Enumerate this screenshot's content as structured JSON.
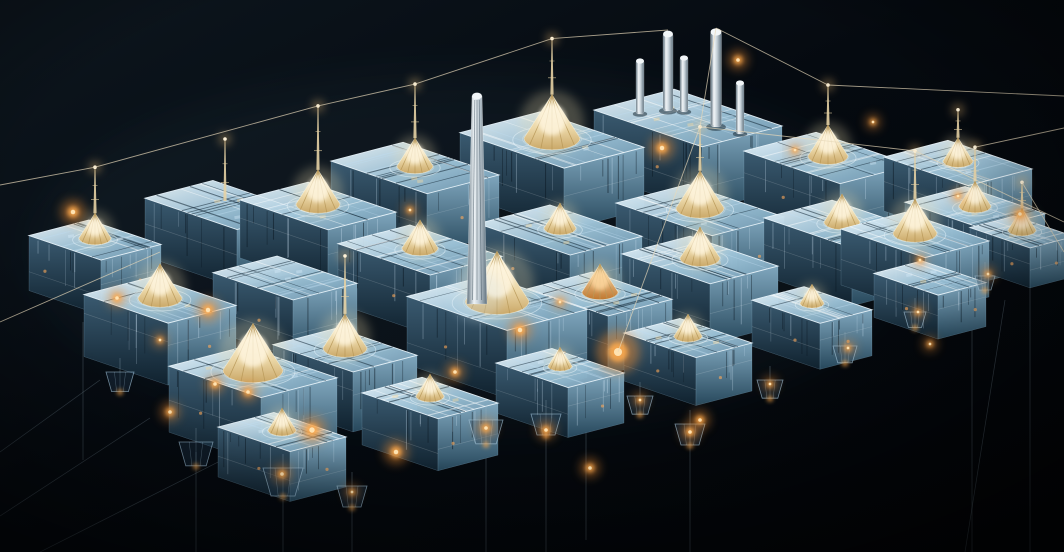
{
  "scene": {
    "width": 1064,
    "height": 552,
    "palette": {
      "bg_top": "#0d161e",
      "bg_mid": "#050a10",
      "bg_bottom": "#020407",
      "ice_top_light": "#eef7fc",
      "ice_top_mid": "#9dc3d8",
      "ice_top_dark": "#6f98b0",
      "face_left_light": "#3a5a70",
      "face_left_dark": "#10222f",
      "face_right_light": "#7fa6bd",
      "face_right_dark": "#27485c",
      "edge_highlight": "#e9f5fc",
      "cone_core": "#fff9e8",
      "cone_mid": "#ecd8a8",
      "cone_rim": "#caa868",
      "cone_warm_core": "#ffe9c0",
      "cone_warm_rim": "#c07830",
      "rib": "#b89858",
      "metal_light": "#eef3f6",
      "metal_dark": "#5f717d",
      "wire": "#e8d9ba",
      "cable": "#9fb8c8",
      "amber": "#e98a30",
      "amber_mid": "#ffab4e",
      "amber_core": "#ffe2b0",
      "bloom": "rgba(110,160,195,0.06)"
    },
    "seed": 7,
    "blocks": [
      {
        "x": 95,
        "y": 240,
        "a": 36,
        "b": 30,
        "h": 55,
        "c": 16,
        "m": 46
      },
      {
        "x": 225,
        "y": 205,
        "a": 46,
        "b": 34,
        "h": 58,
        "c": 0,
        "m": 62
      },
      {
        "x": 318,
        "y": 206,
        "a": 44,
        "b": 34,
        "h": 58,
        "c": 22,
        "m": 64
      },
      {
        "x": 415,
        "y": 168,
        "a": 48,
        "b": 36,
        "h": 60,
        "c": 18,
        "m": 54
      },
      {
        "x": 552,
        "y": 140,
        "a": 52,
        "b": 40,
        "h": 62,
        "c": 28,
        "m": 56
      },
      {
        "x": 688,
        "y": 118,
        "a": 54,
        "b": 40,
        "h": 64,
        "c": 0,
        "m": 0
      },
      {
        "x": 828,
        "y": 158,
        "a": 48,
        "b": 36,
        "h": 60,
        "c": 20,
        "m": 40
      },
      {
        "x": 958,
        "y": 163,
        "a": 42,
        "b": 32,
        "h": 54,
        "c": 15,
        "m": 28
      },
      {
        "x": 160,
        "y": 300,
        "a": 42,
        "b": 34,
        "h": 62,
        "c": 22,
        "m": 0
      },
      {
        "x": 285,
        "y": 278,
        "a": 40,
        "b": 32,
        "h": 58,
        "c": 0,
        "m": 0
      },
      {
        "x": 420,
        "y": 250,
        "a": 46,
        "b": 36,
        "h": 60,
        "c": 18,
        "m": 0
      },
      {
        "x": 560,
        "y": 230,
        "a": 46,
        "b": 36,
        "h": 60,
        "c": 16,
        "m": 0
      },
      {
        "x": 700,
        "y": 210,
        "a": 48,
        "b": 36,
        "h": 60,
        "c": 24,
        "m": 44
      },
      {
        "x": 842,
        "y": 224,
        "a": 44,
        "b": 34,
        "h": 58,
        "c": 18,
        "m": 0
      },
      {
        "x": 975,
        "y": 208,
        "a": 40,
        "b": 30,
        "h": 52,
        "c": 16,
        "m": 34
      },
      {
        "x": 253,
        "y": 372,
        "a": 46,
        "b": 38,
        "h": 66,
        "c": 30,
        "m": 0
      },
      {
        "x": 345,
        "y": 350,
        "a": 40,
        "b": 32,
        "h": 60,
        "c": 22,
        "m": 58
      },
      {
        "x": 497,
        "y": 303,
        "a": 50,
        "b": 40,
        "h": 68,
        "c": 32,
        "m": 0
      },
      {
        "x": 600,
        "y": 294,
        "a": 40,
        "b": 32,
        "h": 58,
        "c": 18,
        "m": 0,
        "warm": true
      },
      {
        "x": 700,
        "y": 260,
        "a": 44,
        "b": 34,
        "h": 60,
        "c": 20,
        "m": 0
      },
      {
        "x": 915,
        "y": 235,
        "a": 42,
        "b": 32,
        "h": 56,
        "c": 22,
        "m": 48
      },
      {
        "x": 282,
        "y": 432,
        "a": 36,
        "b": 28,
        "h": 50,
        "c": 14,
        "m": 0
      },
      {
        "x": 430,
        "y": 398,
        "a": 38,
        "b": 30,
        "h": 52,
        "c": 14,
        "m": 0
      },
      {
        "x": 560,
        "y": 368,
        "a": 36,
        "b": 28,
        "h": 50,
        "c": 12,
        "m": 0
      },
      {
        "x": 688,
        "y": 338,
        "a": 36,
        "b": 28,
        "h": 48,
        "c": 14,
        "m": 0
      },
      {
        "x": 812,
        "y": 305,
        "a": 34,
        "b": 26,
        "h": 46,
        "c": 12,
        "m": 0
      },
      {
        "x": 930,
        "y": 278,
        "a": 32,
        "b": 24,
        "h": 44,
        "c": 0,
        "m": 0
      },
      {
        "x": 1022,
        "y": 232,
        "a": 30,
        "b": 22,
        "h": 40,
        "c": 14,
        "m": 26
      }
    ],
    "towers": [
      {
        "x": 640,
        "y": 60,
        "w": 8,
        "h": 54
      },
      {
        "x": 668,
        "y": 33,
        "w": 10,
        "h": 78
      },
      {
        "x": 684,
        "y": 57,
        "w": 8,
        "h": 55
      },
      {
        "x": 716,
        "y": 31,
        "w": 11,
        "h": 96
      },
      {
        "x": 740,
        "y": 82,
        "w": 8,
        "h": 52
      }
    ],
    "obelisk": {
      "x": 477,
      "top": 96,
      "bottom": 304,
      "w_top": 10,
      "w_base": 20
    },
    "wires": [
      {
        "from": {
          "x": 0,
          "y": 185
        },
        "to": {
          "block": 0
        }
      },
      {
        "from": {
          "block": 0
        },
        "to": {
          "block": 2
        }
      },
      {
        "from": {
          "block": 2
        },
        "to": {
          "block": 3
        }
      },
      {
        "from": {
          "block": 3
        },
        "to": {
          "block": 4
        }
      },
      {
        "from": {
          "block": 4
        },
        "to": {
          "x": 668,
          "y": 30
        }
      },
      {
        "from": {
          "x": 716,
          "y": 28
        },
        "to": {
          "block": 6
        }
      },
      {
        "from": {
          "block": 6
        },
        "to": {
          "x": 1064,
          "y": 96
        }
      },
      {
        "from": {
          "x": 716,
          "y": 28
        },
        "to": {
          "block": 12
        }
      },
      {
        "from": {
          "block": 12
        },
        "to": {
          "block": 20
        }
      },
      {
        "from": {
          "block": 20
        },
        "to": {
          "x": 1064,
          "y": 222
        }
      },
      {
        "from": {
          "block": 14
        },
        "to": {
          "x": 1064,
          "y": 128
        }
      },
      {
        "from": {
          "x": 0,
          "y": 322
        },
        "to": {
          "x": 160,
          "y": 252
        }
      },
      {
        "from": {
          "block": 12
        },
        "to": {
          "x": 618,
          "y": 352
        }
      },
      {
        "from": {
          "block": 27
        },
        "to": {
          "x": 1064,
          "y": 252
        }
      }
    ],
    "cables": [
      {
        "x": 83,
        "y1": 322,
        "y2": 460
      },
      {
        "x": 196,
        "y1": 452,
        "y2": 552
      },
      {
        "x": 283,
        "y1": 470,
        "y2": 552
      },
      {
        "x": 352,
        "y1": 486,
        "y2": 552
      },
      {
        "x": 486,
        "y1": 426,
        "y2": 552
      },
      {
        "x": 546,
        "y1": 400,
        "y2": 552
      },
      {
        "x": 586,
        "y1": 392,
        "y2": 540
      },
      {
        "x": 690,
        "y1": 428,
        "y2": 552
      },
      {
        "x": 972,
        "y1": 300,
        "y2": 552
      },
      {
        "x": 1030,
        "y1": 248,
        "y2": 552
      }
    ],
    "diagonal_cables": [
      {
        "x1": 150,
        "y1": 418,
        "x2": 0,
        "y2": 516
      },
      {
        "x1": 238,
        "y1": 452,
        "x2": 40,
        "y2": 552
      },
      {
        "x1": 100,
        "y1": 380,
        "x2": 0,
        "y2": 452
      },
      {
        "x1": 1005,
        "y1": 300,
        "x2": 965,
        "y2": 552
      }
    ],
    "pods": [
      {
        "x": 120,
        "y": 372,
        "s": 28
      },
      {
        "x": 196,
        "y": 442,
        "s": 34
      },
      {
        "x": 283,
        "y": 468,
        "s": 40
      },
      {
        "x": 352,
        "y": 486,
        "s": 30
      },
      {
        "x": 486,
        "y": 420,
        "s": 34
      },
      {
        "x": 546,
        "y": 414,
        "s": 30
      },
      {
        "x": 640,
        "y": 396,
        "s": 26
      },
      {
        "x": 690,
        "y": 424,
        "s": 30
      },
      {
        "x": 770,
        "y": 380,
        "s": 26
      },
      {
        "x": 845,
        "y": 346,
        "s": 24
      },
      {
        "x": 915,
        "y": 312,
        "s": 22
      },
      {
        "x": 985,
        "y": 276,
        "s": 20
      }
    ],
    "glows": [
      {
        "x": 73,
        "y": 212,
        "r": 5
      },
      {
        "x": 117,
        "y": 298,
        "r": 4
      },
      {
        "x": 208,
        "y": 310,
        "r": 5
      },
      {
        "x": 170,
        "y": 412,
        "r": 4
      },
      {
        "x": 312,
        "y": 430,
        "r": 6
      },
      {
        "x": 396,
        "y": 452,
        "r": 5
      },
      {
        "x": 248,
        "y": 392,
        "r": 4
      },
      {
        "x": 520,
        "y": 330,
        "r": 5
      },
      {
        "x": 455,
        "y": 372,
        "r": 4
      },
      {
        "x": 618,
        "y": 352,
        "r": 9
      },
      {
        "x": 662,
        "y": 148,
        "r": 5
      },
      {
        "x": 738,
        "y": 60,
        "r": 4
      },
      {
        "x": 700,
        "y": 420,
        "r": 4
      },
      {
        "x": 590,
        "y": 468,
        "r": 4
      },
      {
        "x": 486,
        "y": 428,
        "r": 4
      },
      {
        "x": 546,
        "y": 430,
        "r": 4
      },
      {
        "x": 640,
        "y": 400,
        "r": 3
      },
      {
        "x": 690,
        "y": 432,
        "r": 4
      },
      {
        "x": 770,
        "y": 384,
        "r": 3
      },
      {
        "x": 848,
        "y": 348,
        "r": 3
      },
      {
        "x": 918,
        "y": 312,
        "r": 3
      },
      {
        "x": 988,
        "y": 274,
        "r": 3
      },
      {
        "x": 1020,
        "y": 214,
        "r": 4
      },
      {
        "x": 930,
        "y": 344,
        "r": 3
      },
      {
        "x": 795,
        "y": 150,
        "r": 3
      },
      {
        "x": 873,
        "y": 122,
        "r": 3
      },
      {
        "x": 560,
        "y": 302,
        "r": 3
      },
      {
        "x": 410,
        "y": 210,
        "r": 3
      },
      {
        "x": 215,
        "y": 384,
        "r": 4
      },
      {
        "x": 282,
        "y": 474,
        "r": 4
      },
      {
        "x": 352,
        "y": 492,
        "r": 3
      },
      {
        "x": 160,
        "y": 340,
        "r": 3
      },
      {
        "x": 920,
        "y": 260,
        "r": 3
      },
      {
        "x": 958,
        "y": 196,
        "r": 3
      }
    ]
  }
}
